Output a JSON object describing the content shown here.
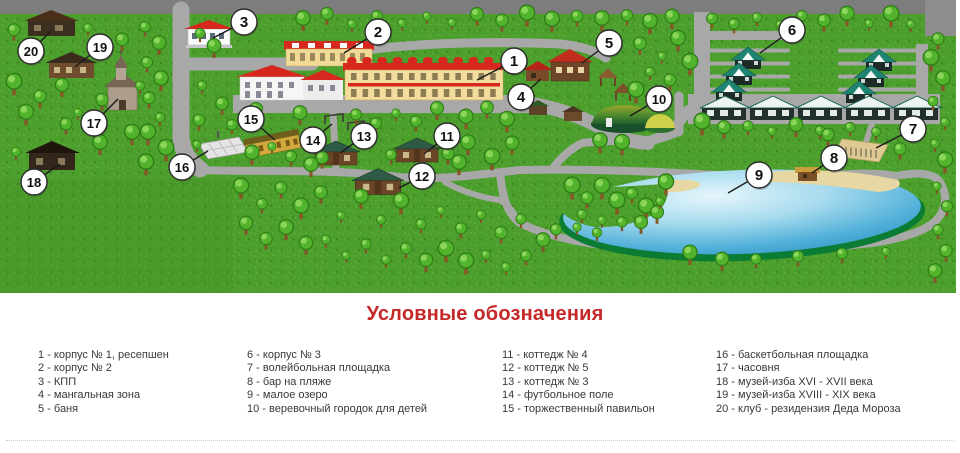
{
  "legend": {
    "title": "Условные обозначения",
    "title_color": "#c62828",
    "columns": [
      {
        "items": [
          "1 - корпус № 1, ресепшен",
          "2 - корпус № 2",
          "3 - КПП",
          "4 - мангальная зона",
          "5 - баня"
        ]
      },
      {
        "items": [
          "6 - корпус № 3",
          "7 - волейбольная площадка",
          "8 - бар на пляже",
          "9 - малое озеро",
          "10 - веревочный городок для детей"
        ]
      },
      {
        "items": [
          "11 - коттедж № 4",
          "12 - коттедж № 5",
          "13 - коттедж № 3",
          "14 - футбольное поле",
          "15 - торжественный павильон"
        ]
      },
      {
        "items": [
          "16 - баскетбольная площадка",
          "17 - часовня",
          "18 - музей-изба XVI - XVII века",
          "19 - музей-изба XVIII - XIX века",
          "20 - клуб - резидензия Деда Мороза"
        ]
      }
    ]
  },
  "map": {
    "markers": [
      {
        "num": "1",
        "x": 514,
        "y": 61,
        "tx": 477,
        "ty": 80
      },
      {
        "num": "2",
        "x": 378,
        "y": 32,
        "tx": 344,
        "ty": 53
      },
      {
        "num": "3",
        "x": 244,
        "y": 22,
        "tx": 213,
        "ty": 38
      },
      {
        "num": "4",
        "x": 521,
        "y": 97,
        "tx": 541,
        "ty": 79
      },
      {
        "num": "5",
        "x": 609,
        "y": 43,
        "tx": 582,
        "ty": 63
      },
      {
        "num": "6",
        "x": 792,
        "y": 30,
        "tx": 760,
        "ty": 53
      },
      {
        "num": "7",
        "x": 913,
        "y": 129,
        "tx": 876,
        "ty": 148
      },
      {
        "num": "8",
        "x": 834,
        "y": 158,
        "tx": 812,
        "ty": 173
      },
      {
        "num": "9",
        "x": 759,
        "y": 175,
        "tx": 728,
        "ty": 193
      },
      {
        "num": "10",
        "x": 659,
        "y": 99,
        "tx": 630,
        "ty": 116
      },
      {
        "num": "11",
        "x": 447,
        "y": 136,
        "tx": 424,
        "ty": 154
      },
      {
        "num": "12",
        "x": 422,
        "y": 176,
        "tx": 399,
        "ty": 188
      },
      {
        "num": "13",
        "x": 364,
        "y": 136,
        "tx": 340,
        "ty": 153
      },
      {
        "num": "14",
        "x": 313,
        "y": 140,
        "tx": 332,
        "ty": 124
      },
      {
        "num": "15",
        "x": 251,
        "y": 119,
        "tx": 275,
        "ty": 140
      },
      {
        "num": "16",
        "x": 182,
        "y": 167,
        "tx": 208,
        "ty": 151
      },
      {
        "num": "17",
        "x": 94,
        "y": 123,
        "tx": 118,
        "ty": 99
      },
      {
        "num": "18",
        "x": 34,
        "y": 182,
        "tx": 60,
        "ty": 164
      },
      {
        "num": "19",
        "x": 100,
        "y": 47,
        "tx": 75,
        "ty": 67
      },
      {
        "num": "20",
        "x": 31,
        "y": 51,
        "tx": 51,
        "ty": 31
      }
    ]
  },
  "colors": {
    "grass": "#4c9e2d",
    "road": "#a8a8a8",
    "red_roof": "#d6281e",
    "teal_roof": "#1f8573",
    "lake_deep": "#2d97c6",
    "lake_light": "#e6f6fb",
    "sand": "#e7d7a2",
    "marker_fill": "#ffffff",
    "marker_stroke": "#2b2b2b"
  }
}
